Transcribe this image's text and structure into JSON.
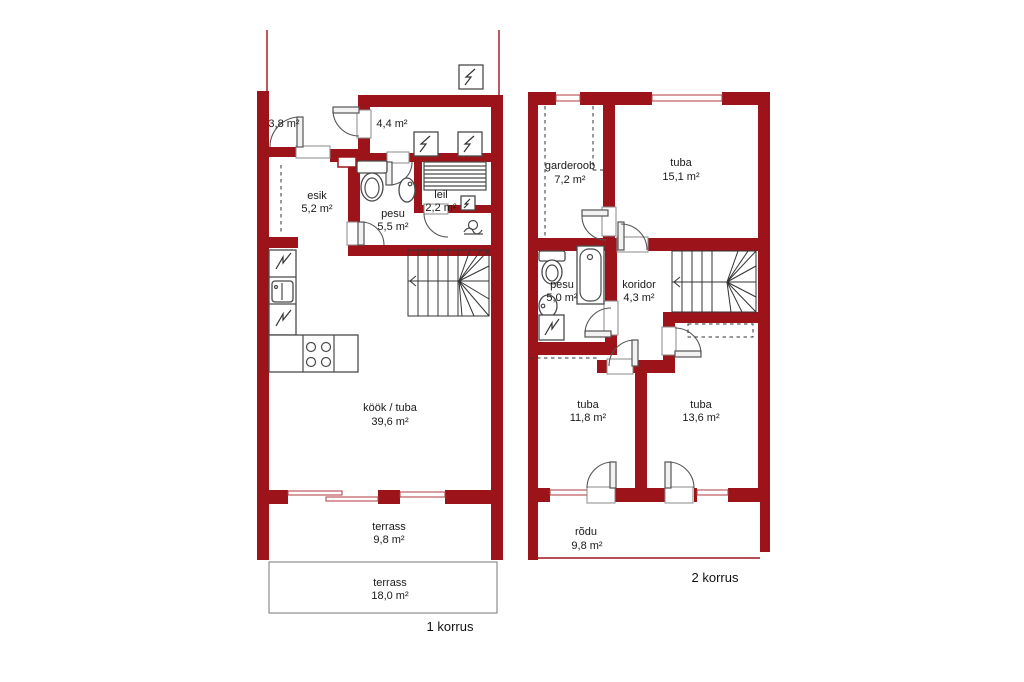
{
  "colors": {
    "wall": "#9C1419",
    "window_line": "#B03A3E",
    "fixture_line": "#4a4a4a",
    "stair_line": "#333333",
    "text": "#1a1a1a"
  },
  "floor1": {
    "caption": "1 korrus",
    "rooms": {
      "porch": {
        "area": "3,8 m²"
      },
      "tambur": {
        "area": "4,4 m²"
      },
      "esik": {
        "name": "esik",
        "area": "5,2 m²"
      },
      "pesu": {
        "name": "pesu",
        "area": "5,5 m²"
      },
      "leil": {
        "name": "leil",
        "area": "2,2 m²"
      },
      "kook_tuba": {
        "name": "köök / tuba",
        "area": "39,6 m²"
      },
      "terrass_upper": {
        "name": "terrass",
        "area": "9,8 m²"
      },
      "terrass_lower": {
        "name": "terrass",
        "area": "18,0 m²"
      }
    }
  },
  "floor2": {
    "caption": "2 korrus",
    "rooms": {
      "garderoob": {
        "name": "garderoob",
        "area": "7,2 m²"
      },
      "tuba_large": {
        "name": "tuba",
        "area": "15,1 m²"
      },
      "pesu": {
        "name": "pesu",
        "area": "5,0 m²"
      },
      "koridor": {
        "name": "koridor",
        "area": "4,3 m²"
      },
      "tuba_sw": {
        "name": "tuba",
        "area": "11,8 m²"
      },
      "tuba_se": {
        "name": "tuba",
        "area": "13,6 m²"
      },
      "rodu": {
        "name": "rõdu",
        "area": "9,8 m²"
      }
    }
  }
}
